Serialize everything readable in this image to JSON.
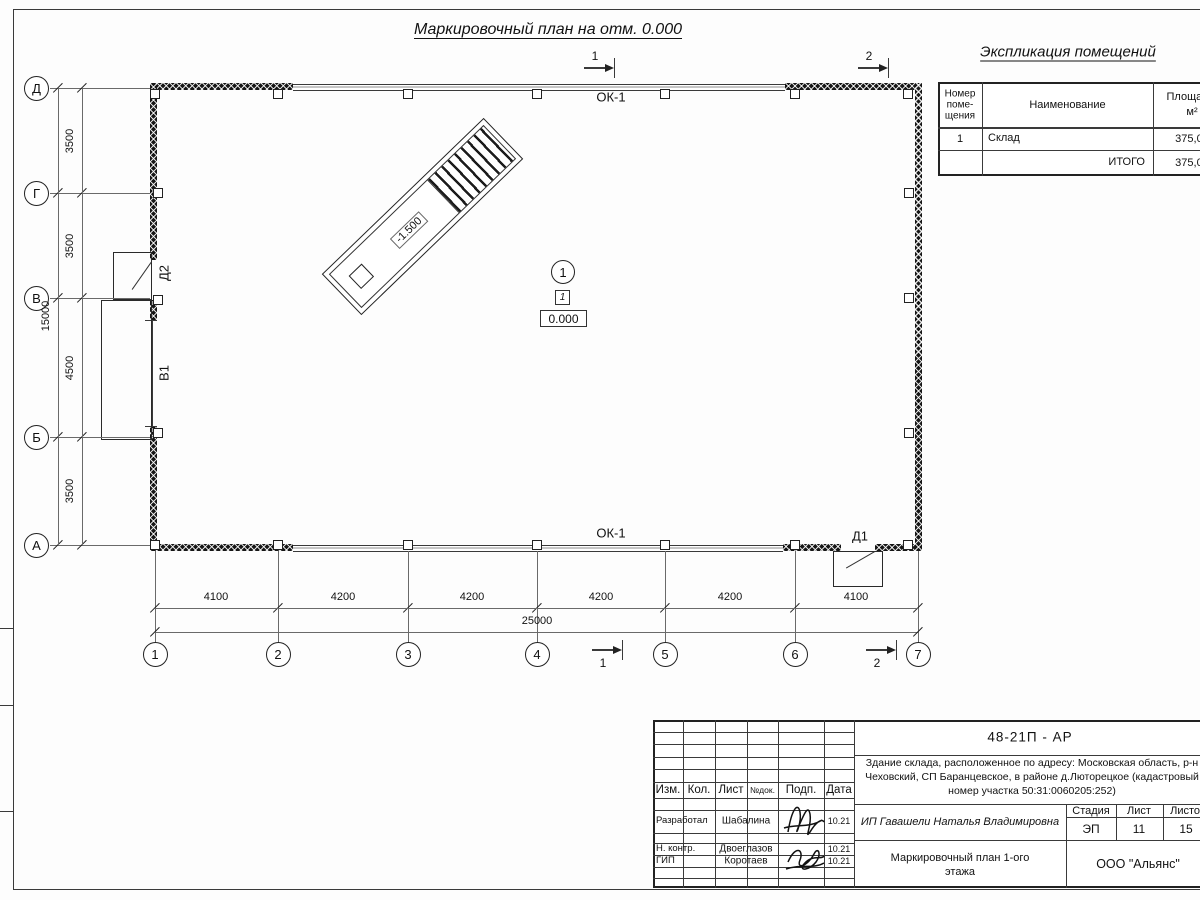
{
  "plan": {
    "title": "Маркировочный план на отм. 0.000",
    "window_top": "ОК-1",
    "window_bottom": "ОК-1",
    "door_d2": "Д2",
    "door_d1": "Д1",
    "gate_b1": "В1",
    "ramp_elevation": "-1.500",
    "room_circle": "1",
    "room_square": "1",
    "floor_elevation": "0.000",
    "section_markers": [
      "1",
      "2"
    ]
  },
  "axes": {
    "letters": [
      "Д",
      "Г",
      "В",
      "Б",
      "А"
    ],
    "numbers": [
      "1",
      "2",
      "3",
      "4",
      "5",
      "6",
      "7"
    ]
  },
  "dimensions": {
    "left_segments": [
      "3500",
      "3500",
      "4500",
      "3500"
    ],
    "left_total": "15000",
    "bottom_segments": [
      "4100",
      "4200",
      "4200",
      "4200",
      "4200",
      "4100"
    ],
    "bottom_total": "25000"
  },
  "explication": {
    "title": "Экспликация помещений",
    "col_number_lines": [
      "Номер",
      "поме-",
      "щения"
    ],
    "col_name": "Наименование",
    "col_area_lines": [
      "Площадь,",
      "м²"
    ],
    "rows": [
      {
        "num": "1",
        "name": "Склад",
        "area": "375,00",
        "name_align": "left"
      },
      {
        "num": "",
        "name": "ИТОГО",
        "area": "375,00",
        "name_align": "right"
      }
    ]
  },
  "titleblock": {
    "doc_number": "48-21П - АР",
    "address_lines": [
      "Здание склада, расположенное по адресу: Московская область, р-н",
      "Чеховский, СП Баранцевское, в районе д.Люторецкое  (кадастровый",
      "номер участка 50:31:0060205:252)"
    ],
    "header_cells": [
      "Изм.",
      "Кол.",
      "Лист",
      "№док.",
      "Подп.",
      "Дата"
    ],
    "sign_rows": [
      {
        "role": "Разработал",
        "name": "Шабалина",
        "date": "10.21"
      },
      {
        "role": "Н. контр.",
        "name": "Двоеглазов",
        "date": "10.21"
      },
      {
        "role": "ГИП",
        "name": "Коротаев",
        "date": "10.21"
      }
    ],
    "client": "ИП Гавашели Наталья Владимировна",
    "stage_label": "Стадия",
    "sheet_label": "Лист",
    "sheets_label": "Листов",
    "stage": "ЭП",
    "sheet_num": "11",
    "sheets_total": "15",
    "drawing_name_lines": [
      "Маркировочный план 1-ого",
      "этажа"
    ],
    "company": "ООО \"Альянс\""
  }
}
